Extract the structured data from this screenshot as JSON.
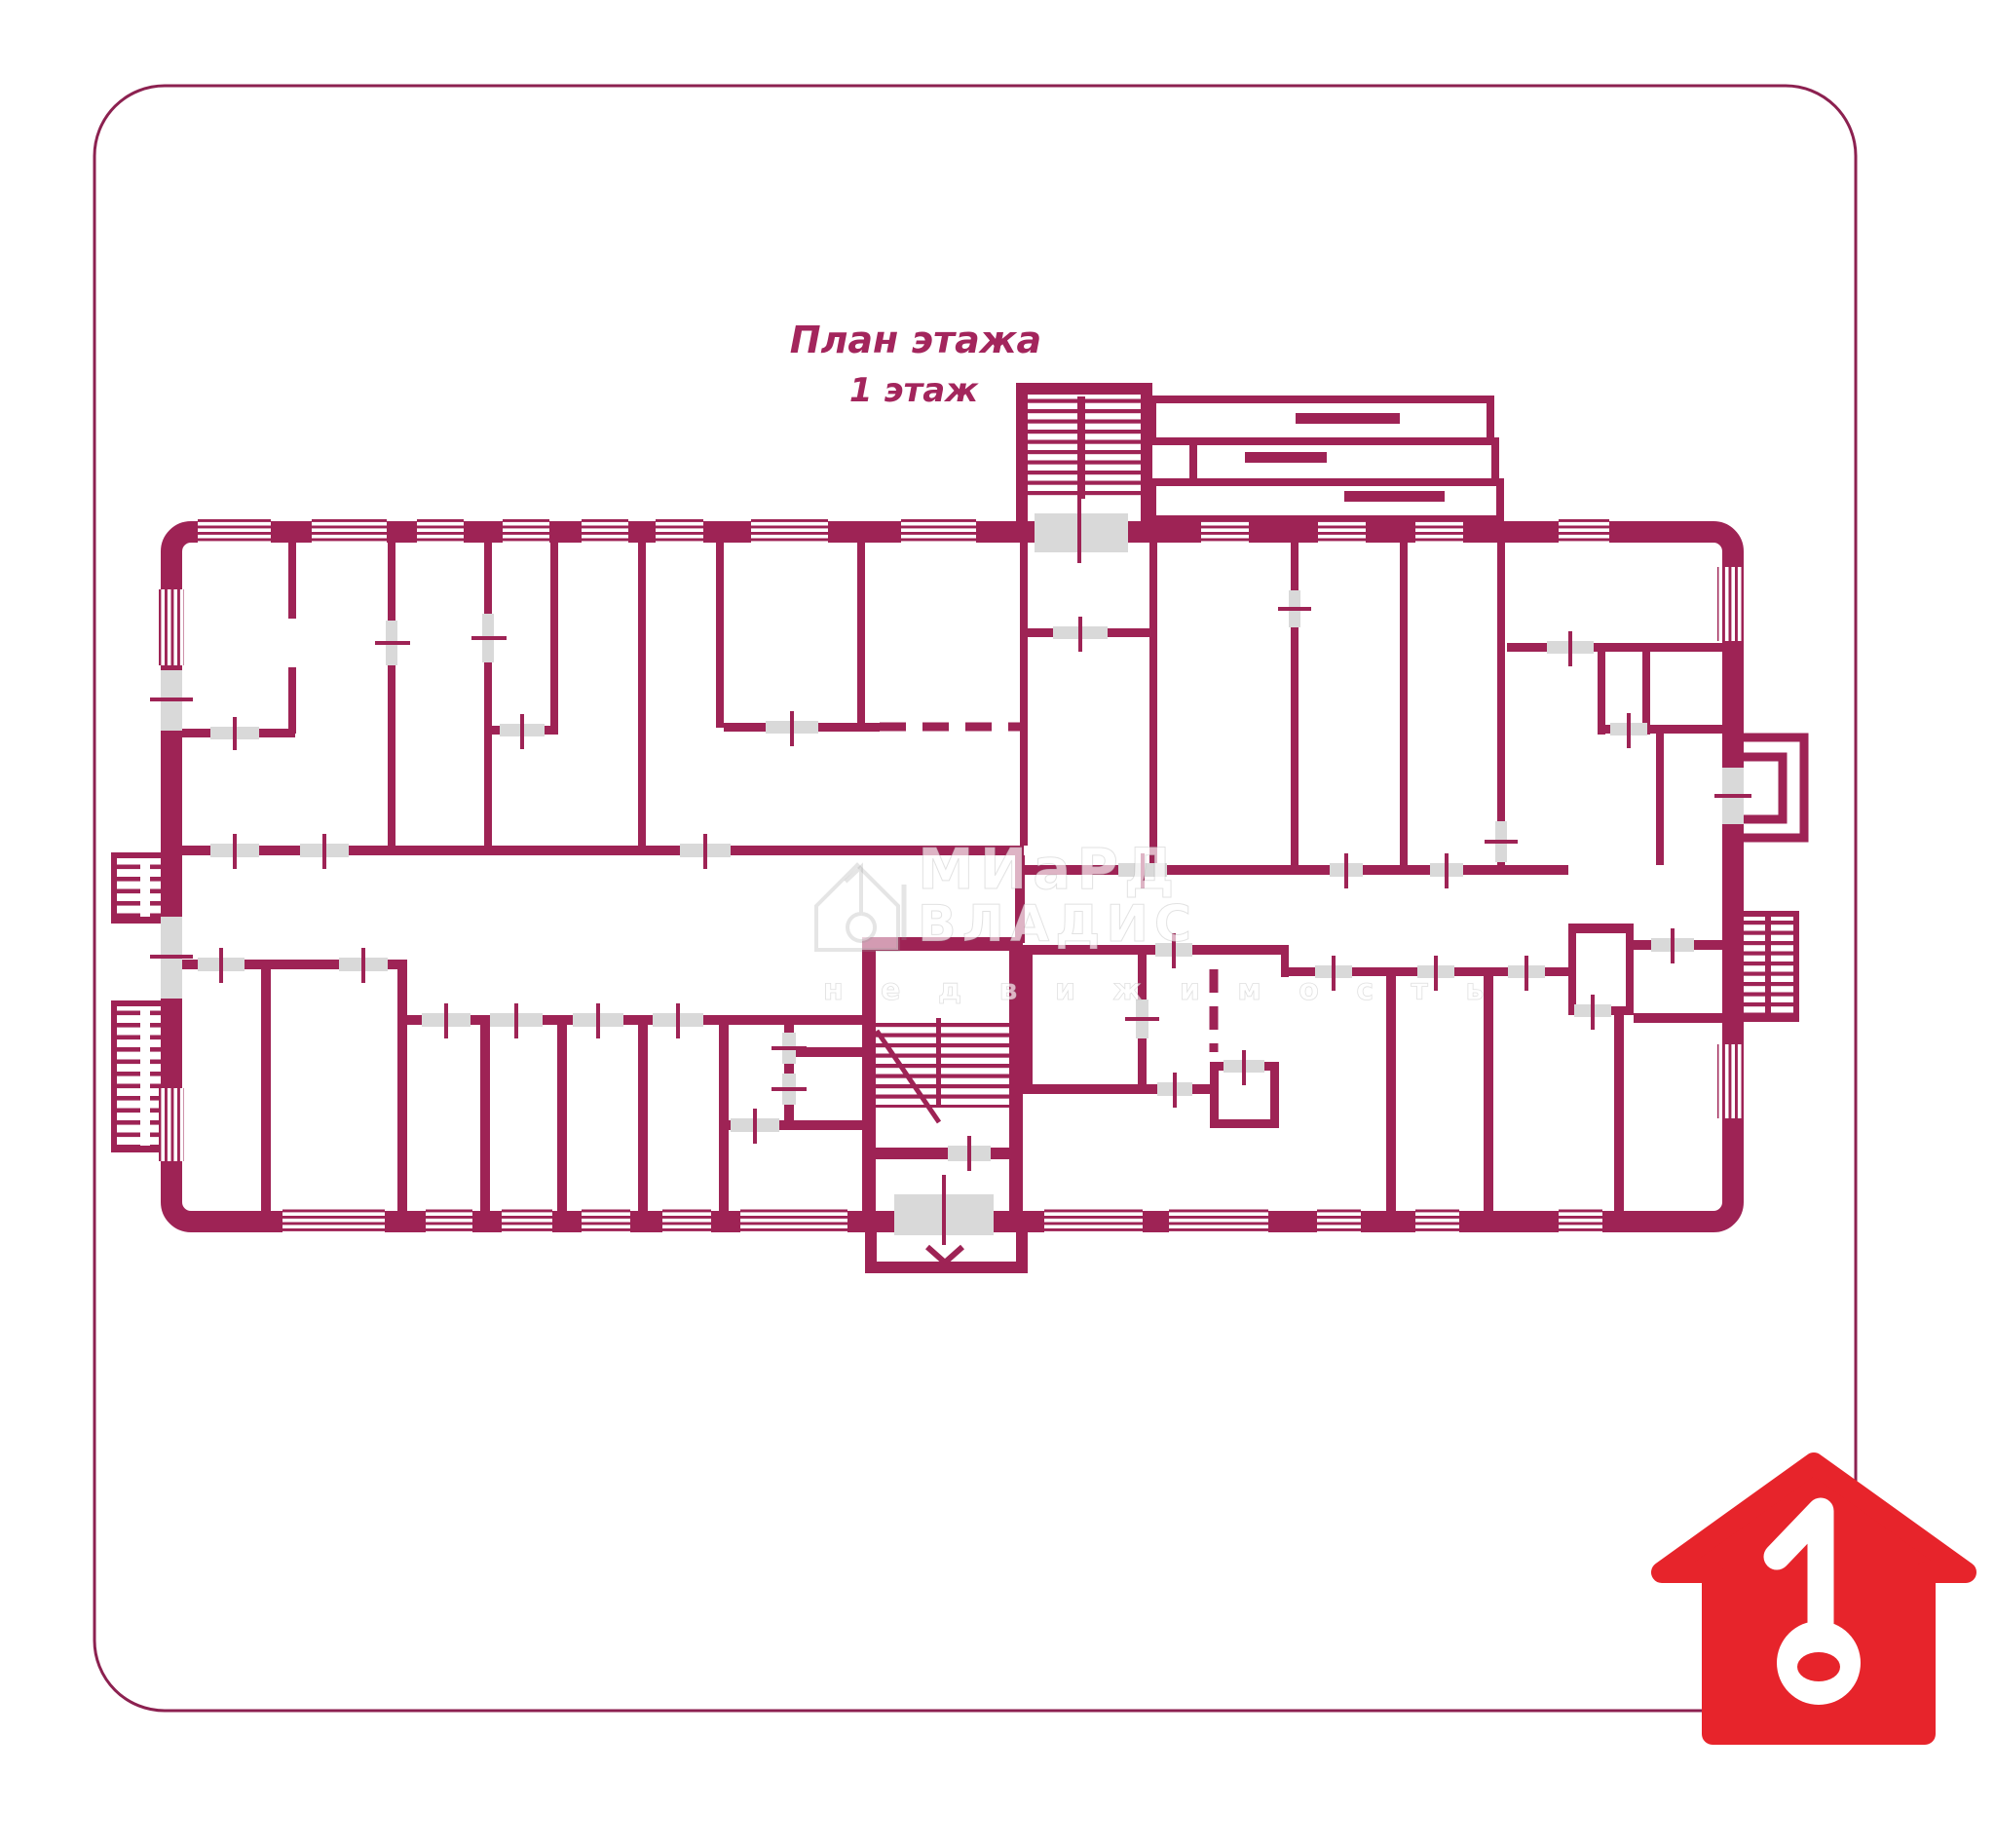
{
  "colors": {
    "wall": "#9e2355",
    "door": "#d9d9d9",
    "title": "#a3255c",
    "border": "#8c2150",
    "logo_red": "#e7242b",
    "watermark_gray": "#ededed"
  },
  "title": {
    "line1": "План этажа",
    "line2": "1 этаж"
  },
  "watermark": {
    "brand_line1": "МИаРД",
    "brand_line2": "ВЛАДИС",
    "tagline": "н е д в и ж и м о с т ь"
  },
  "logo": {
    "symbol": "1",
    "description": "red house with white key-shaped digit 1"
  }
}
